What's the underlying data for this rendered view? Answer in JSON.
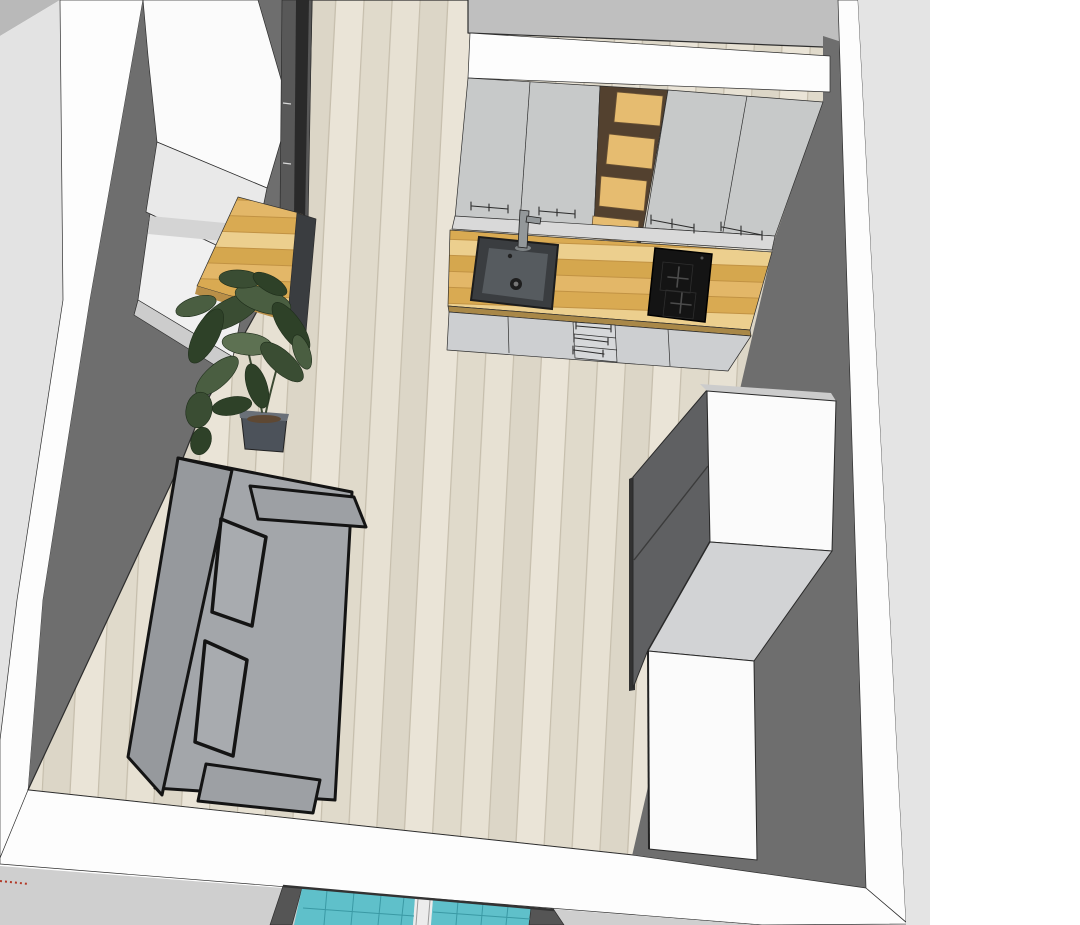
{
  "canvas": {
    "width": 1080,
    "height": 925
  },
  "scene": {
    "title": "3D interior model view - open-plan living room with kitchen, seen from above",
    "objects": [
      "left-wall",
      "back-wall",
      "right-wall",
      "bottom-wall-with-window",
      "wood-plank-floor",
      "kitchen-upper-cabinets",
      "open-wood-shelves",
      "wood-countertop",
      "kitchen-sink",
      "faucet",
      "induction-cooktop",
      "kitchen-base-cabinets",
      "drawer-stack",
      "tall-white-storage-boxes",
      "wood-desk",
      "dark-tall-cabinet",
      "potted-plant",
      "gray-sofa",
      "media-sideboard",
      "white-box-upper",
      "white-box-lower",
      "window-two-panes",
      "red-axis-mark"
    ],
    "counts": {
      "open_shelves": 4,
      "upper_cabinet_doors": 4,
      "upper_cabinet_handles": 4,
      "drawer_handles": 3,
      "sofa_back_cushions": 2,
      "window_panes": 2,
      "cooktop_burners": 2
    }
  },
  "palette": {
    "page_bg": "#ffffff",
    "outside_top": "#bfbfbf",
    "corner_tri": "#b9b9b9",
    "exterior_left": "#e3e3e3",
    "exterior_right": "#e4e4e4",
    "exterior_bottom": "#cfcfcf",
    "wall_top": "#fdfdfd",
    "wall_interior": "#6e6e6e",
    "edge": "#2e2e2e",
    "floor_a": "#eae4d7",
    "floor_b": "#e0dacb",
    "floor_c": "#e7e1d3",
    "floor_d": "#dcd6c7",
    "floor_line": "#c6beac",
    "wood_a": "#e3b768",
    "wood_b": "#d9aa52",
    "wood_c": "#eccf8e",
    "wood_d": "#d5a74e",
    "wood_line": "#c19243",
    "cab_front": "#c7c9c9",
    "cab_soffit": "#d9d9d9",
    "shelf_wood": "#e6bc70",
    "shelf_nook": "#53412f",
    "sink_outer": "#3a3d40",
    "sink_inner": "#565b5f",
    "sink_drain": "#1e1e1e",
    "faucet": "#93989a",
    "cooktop": "#141414",
    "cooktop_mark": "#4c4c4c",
    "base_front": "#cdcfd1",
    "drawer_front": "#d6d8da",
    "handle": "#2b2b2b",
    "box_white": "#fbfbfb",
    "box_shade": "#e9e9e9",
    "box_white2": "#f0f0f0",
    "box_side": "#cccccc",
    "overhang": "#d4d4d4",
    "slab": "#585858",
    "slab_inner": "#2a2a2a",
    "slab_tick": "#d8d8d8",
    "desk_edge": "#b98f48",
    "pot": "#4c525a",
    "pot_rim": "#6a7078",
    "soil": "#5e4833",
    "leaf_dark": "#2e4128",
    "leaf_mid": "#3a4d33",
    "leaf_light": "#4a5e41",
    "leaf_pale": "#5d7152",
    "leaf_edge": "#1f2e1b",
    "sofa_seat": "#a3a6aa",
    "sofa_back": "#96999d",
    "sofa_arm": "#9da0a4",
    "sofa_cushion": "#a8abaf",
    "sofa_line": "#141414",
    "media": "#5f6062",
    "media_line": "#3b3b3b",
    "media_sliver": "#323232",
    "table_top": "#d2d3d5",
    "glass": "#5fc0ca",
    "glass_line": "#3a99a4",
    "win_frame": "#555555",
    "win_mullion": "#ececec",
    "axis_red": "#b23a28",
    "counter_edge": "#a98848"
  }
}
